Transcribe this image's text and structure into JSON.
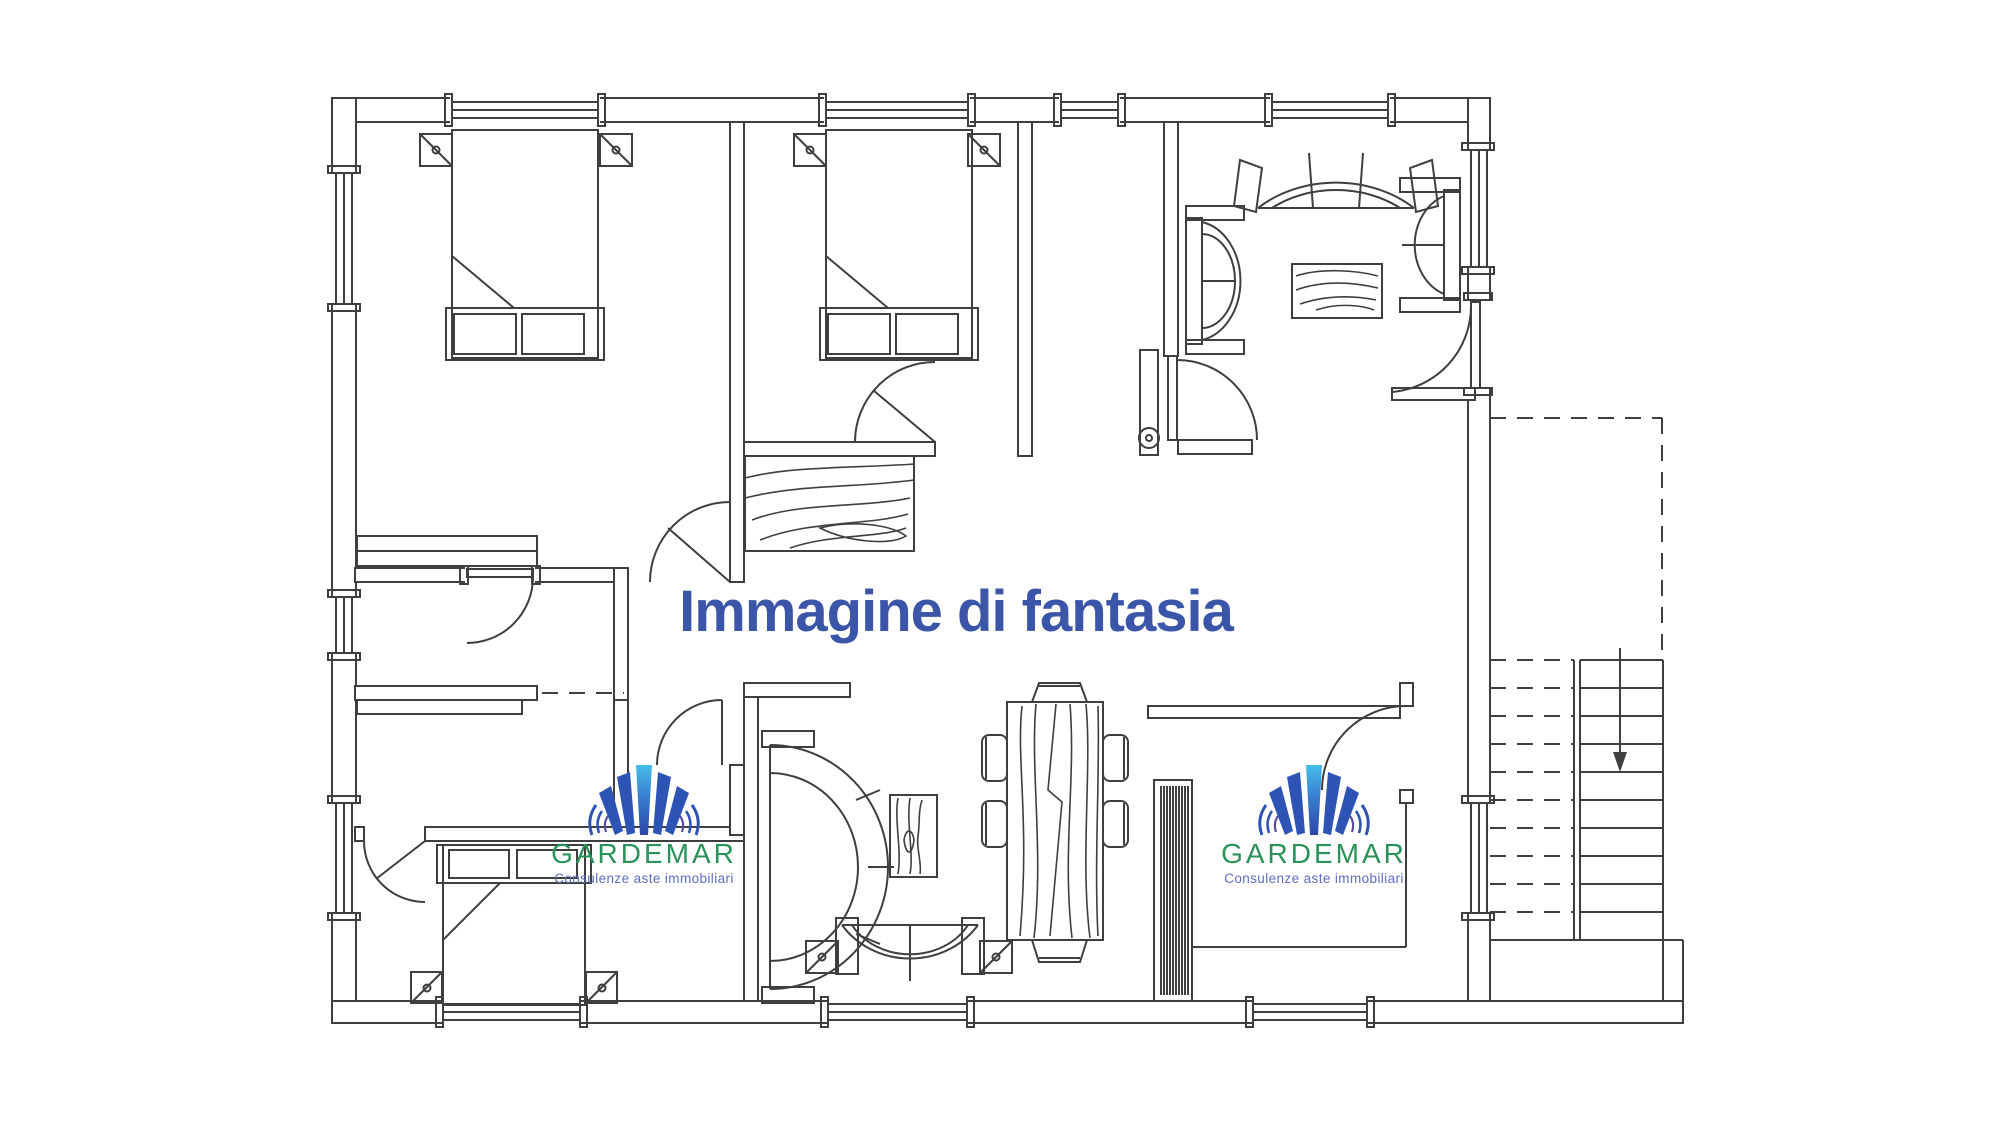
{
  "caption": {
    "text": "Immagine di fantasia",
    "color": "#3b55a8"
  },
  "logo": {
    "brand": "GARDEMAR",
    "tagline": "Consulenze aste immobiliari",
    "brand_color": "#2a9158",
    "tagline_color": "#5f6cc2",
    "mark_icon": "gardemar-fan-icon",
    "mark_center_bar_top_color": "#45bce8",
    "mark_center_bar_bottom_color": "#2b46a5",
    "mark_side_bar_color": "#2d53b5"
  },
  "plan": {
    "type": "apartment-floor-plan",
    "line_color": "#3f3f3f",
    "background_color": "#ffffff",
    "stair_arrow_icon": "stairs-down-arrow-icon",
    "entrance_door_icon": "door-peephole-icon",
    "features": {
      "bedrooms": 3,
      "double_beds": 3,
      "sofas": 5,
      "dining_chairs": 6,
      "rugs": 4,
      "windows": 12,
      "exterior_staircase_steps": 10
    }
  }
}
